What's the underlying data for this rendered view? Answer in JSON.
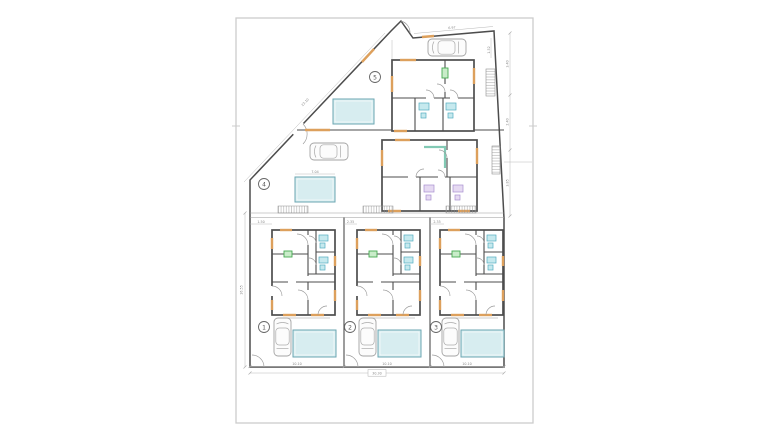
{
  "drawing": {
    "kind_label": "",
    "unit_count": 5
  },
  "colors": {
    "wall": "#4d4d4d",
    "frame": "#cccccc",
    "window": "#dda05c",
    "pool_fill": "#d7edf0",
    "pool_border": "#6ba6b2",
    "cyan_fill": "#c6e9ee",
    "cyan_border": "#53acc0",
    "purple_fill": "#e6daf2",
    "purple_border": "#a88fd0",
    "green_fill": "#c9ecc9",
    "green_border": "#46a951",
    "teal": "#82c9b4"
  },
  "units": [
    {
      "number": "1"
    },
    {
      "number": "2"
    },
    {
      "number": "3"
    },
    {
      "number": "4"
    },
    {
      "number": "5"
    }
  ],
  "dims": {
    "bottom_left": "10.10",
    "bottom_center": "10.10",
    "bottom_right": "10.10",
    "bottom_total": "30.30",
    "left_side": "16.55",
    "diagonal_side": "23.10",
    "top_edge": "6.97",
    "right_upper": "3.40",
    "right_middle": "2.40",
    "right_lower": "3.85",
    "corner_height": "1.52",
    "gap_left": "1.50",
    "gap_center": "2.35",
    "gap_right": "2.35",
    "pool_width": "7.04"
  }
}
